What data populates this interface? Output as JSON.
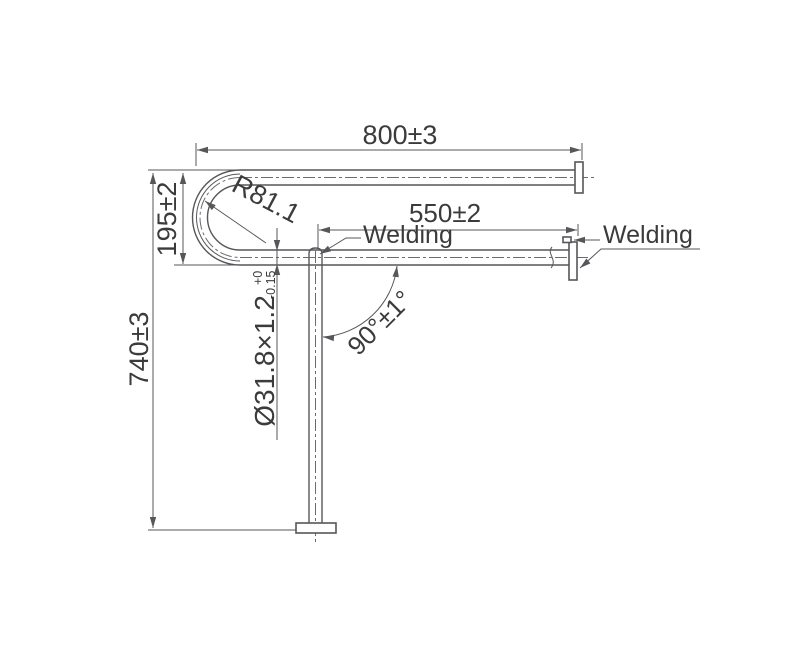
{
  "drawing": {
    "type": "engineering-dimension-drawing",
    "subject": "U-shaped grab bar with floor post",
    "colors": {
      "line": "#56575a",
      "text": "#3b3b3d",
      "background": "#ffffff"
    }
  },
  "texts": {
    "dim_800": "800±3",
    "dim_550": "550±2",
    "dim_195": "195±2",
    "dim_740": "740±3",
    "radius": "R81.1",
    "angle": "90°±1°",
    "tube_spec": "Ø31.8×1.2",
    "tube_tol_plus": "+0",
    "tube_tol_minus": "-0.15",
    "welding_mid": "Welding",
    "welding_right": "Welding"
  }
}
